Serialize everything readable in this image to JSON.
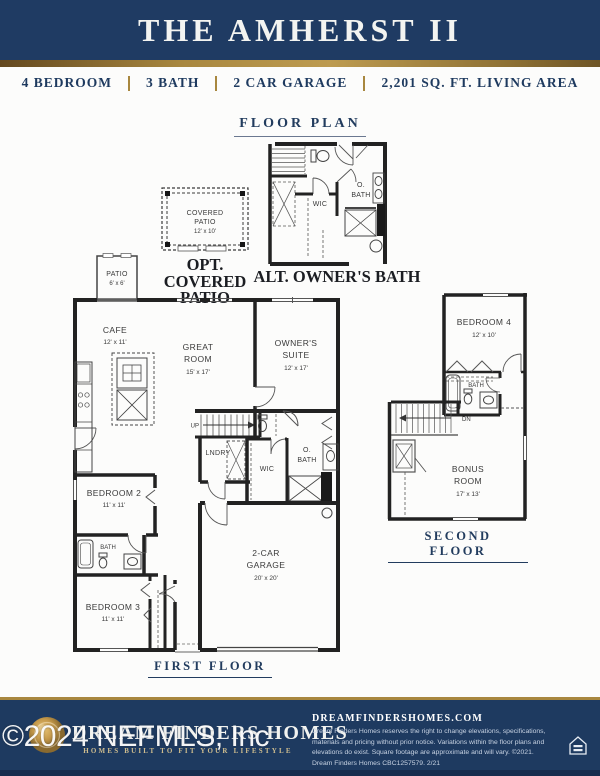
{
  "colors": {
    "navy": "#1f3b63",
    "gold": "#a8873f",
    "wall_ink": "#222222"
  },
  "header": {
    "title": "THE AMHERST II"
  },
  "specs": {
    "items": [
      "4 BEDROOM",
      "3 BATH",
      "2 CAR GARAGE",
      "2,201 SQ. FT. LIVING AREA"
    ]
  },
  "section": {
    "title": "FLOOR PLAN"
  },
  "insets": {
    "patio": {
      "line1": "COVERED",
      "line2": "PATIO",
      "dims": "12' x 10'",
      "caption1": "OPT. COVERED",
      "caption2": "PATIO"
    },
    "altbath": {
      "caption": "ALT. OWNER'S BATH",
      "wic": "WIC",
      "obath1": "O.",
      "obath2": "BATH"
    }
  },
  "first": {
    "caption": "FIRST FLOOR",
    "patio": {
      "name": "PATIO",
      "dims": "6' x 6'"
    },
    "cafe": {
      "name": "CAFE",
      "dims": "12' x 11'"
    },
    "great": {
      "l1": "GREAT",
      "l2": "ROOM",
      "dims": "15' x 17'"
    },
    "suite": {
      "l1": "OWNER'S",
      "l2": "SUITE",
      "dims": "12' x 17'"
    },
    "up": "UP",
    "lndry": "LNDRY",
    "wic": "WIC",
    "obath1": "O.",
    "obath2": "BATH",
    "bed2": {
      "name": "BEDROOM 2",
      "dims": "11' x 11'"
    },
    "bath": "BATH",
    "bed3": {
      "name": "BEDROOM 3",
      "dims": "11' x 11'"
    },
    "garage": {
      "l1": "2-CAR",
      "l2": "GARAGE",
      "dims": "20' x 20'"
    }
  },
  "second": {
    "caption": "SECOND FLOOR",
    "bed4": {
      "name": "BEDROOM 4",
      "dims": "12' x 10'"
    },
    "bath": "BATH",
    "dn": "DN",
    "bonus": {
      "l1": "BONUS",
      "l2": "ROOM",
      "dims": "17' x 13'"
    }
  },
  "footer": {
    "brand": "DREAM FINDERS HOMES",
    "tagline": "HOMES BUILT TO FIT YOUR LIFESTYLE",
    "website": "DREAMFINDERSHOMES.COM",
    "disclaimer": "Dream Finders Homes reserves the right to change elevations, specifications, materials and pricing without prior notice. Variations within the floor plans and elevations do exist. Square footage are approximate and will vary. ©2021. Dream Finders Homes CBC1257579.  2/21"
  },
  "watermark": "©2024 NEFMLS, Inc"
}
